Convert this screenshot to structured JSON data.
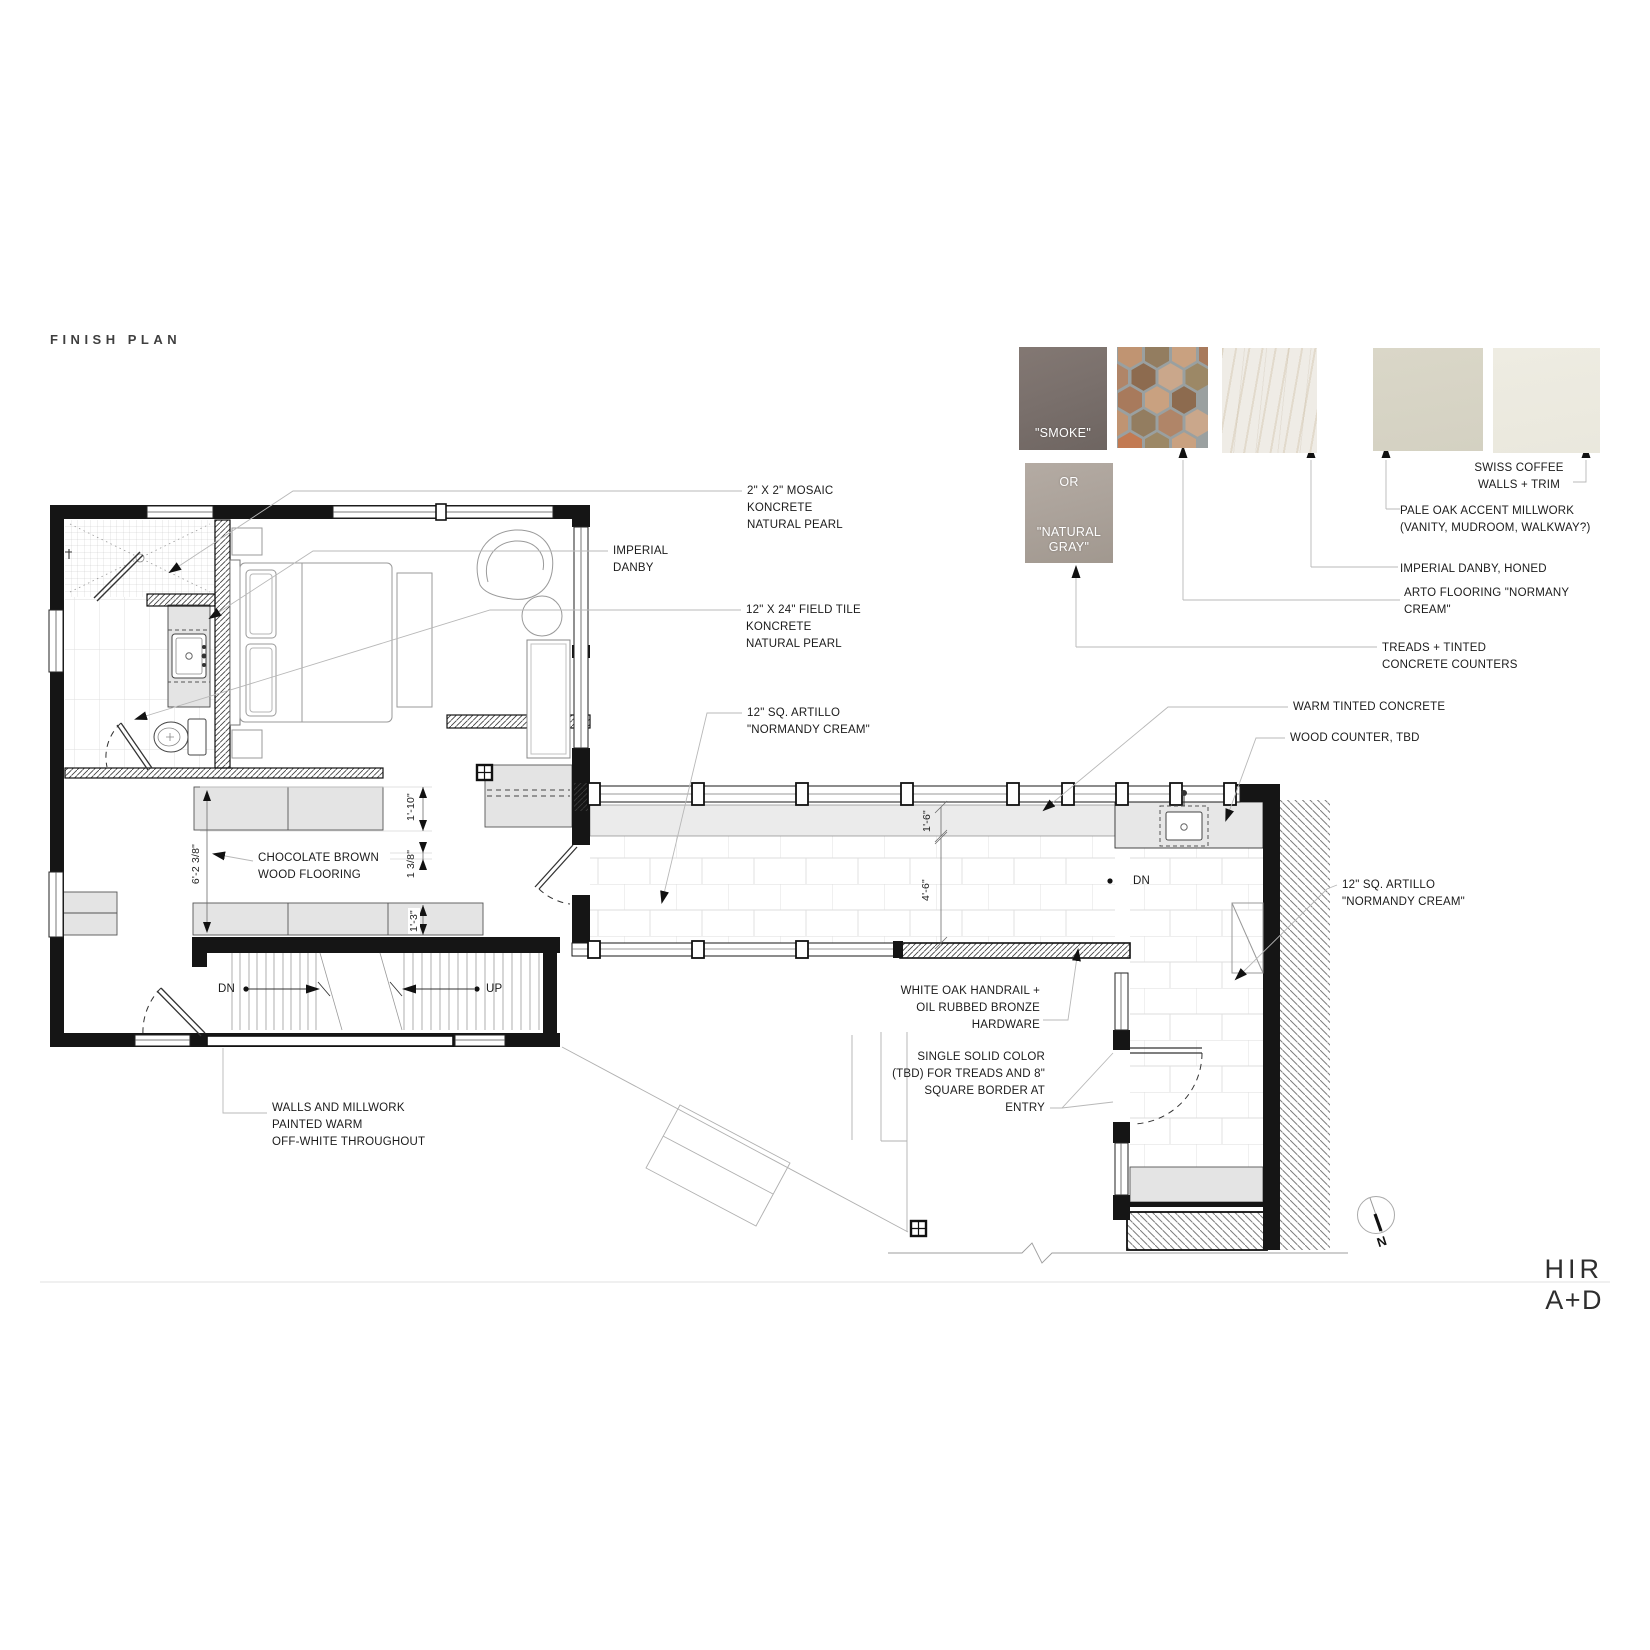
{
  "title": "FINISH PLAN",
  "swatches": {
    "smoke": {
      "label": "\"SMOKE\"",
      "color": "#766c68"
    },
    "natural": {
      "prefix": "OR",
      "label": "\"NATURAL\nGRAY\"",
      "color": "#aaa199"
    },
    "hex_tile": {
      "icon": "arto-hex-mosaic-swatch",
      "grout": "#9aa0a0",
      "tile_colors": [
        "#c09472",
        "#a87a5c",
        "#937d60",
        "#c9a180",
        "#b08568",
        "#8d6b4f",
        "#caa78b",
        "#9c8866"
      ]
    },
    "marble": {
      "icon": "imperial-danby-marble-swatch",
      "color": "#efece6"
    },
    "pale_oak": {
      "color": "#d7d4c5"
    },
    "swiss_coffee": {
      "color": "#ecead fixed"
    }
  },
  "legend": {
    "swiss_coffee": "SWISS COFFEE\nWALLS + TRIM",
    "pale_oak": "PALE OAK ACCENT MILLWORK\n(VANITY, MUDROOM, WALKWAY?)",
    "imperial_danby": "IMPERIAL DANBY, HONED",
    "arto": "ARTO FLOORING \"NORMANY\nCREAM\"",
    "treads": "TREADS + TINTED\nCONCRETE COUNTERS",
    "warm_concrete": "WARM TINTED CONCRETE",
    "wood_counter": "WOOD COUNTER, TBD"
  },
  "plan_notes": {
    "mosaic": "2\" X 2\" MOSAIC\nKONCRETE\nNATURAL PEARL",
    "imperial_danby": "IMPERIAL\nDANBY",
    "field_tile": "12\" X 24\" FIELD TILE\nKONCRETE\nNATURAL PEARL",
    "artillo_walkway": "12\" SQ. ARTILLO\n\"NORMANDY CREAM\"",
    "chocolate": "CHOCOLATE BROWN\nWOOD FLOORING",
    "walls_millwork": "WALLS AND MILLWORK\nPAINTED WARM\nOFF-WHITE THROUGHOUT",
    "white_oak": "WHITE OAK HANDRAIL +\nOIL RUBBED BRONZE\nHARDWARE",
    "single_solid": "SINGLE SOLID COLOR\n(TBD) FOR TREADS AND 8\"\nSQUARE BORDER AT\nENTRY",
    "artillo_entry": "12\" SQ. ARTILLO\n\"NORMANDY CREAM\""
  },
  "dimensions": {
    "hall": "6'-2 3/8\"",
    "closet": "1'-10\"",
    "trim": "1 3/8\"",
    "cabinet": "1'-3\"",
    "band": "1'-6\"",
    "walkway": "4'-6\""
  },
  "stairs": {
    "down": "DN",
    "up": "UP",
    "entry_down": "DN"
  },
  "compass": {
    "north": "N"
  },
  "logo": {
    "line1": "HIR",
    "line2": "A+D"
  }
}
